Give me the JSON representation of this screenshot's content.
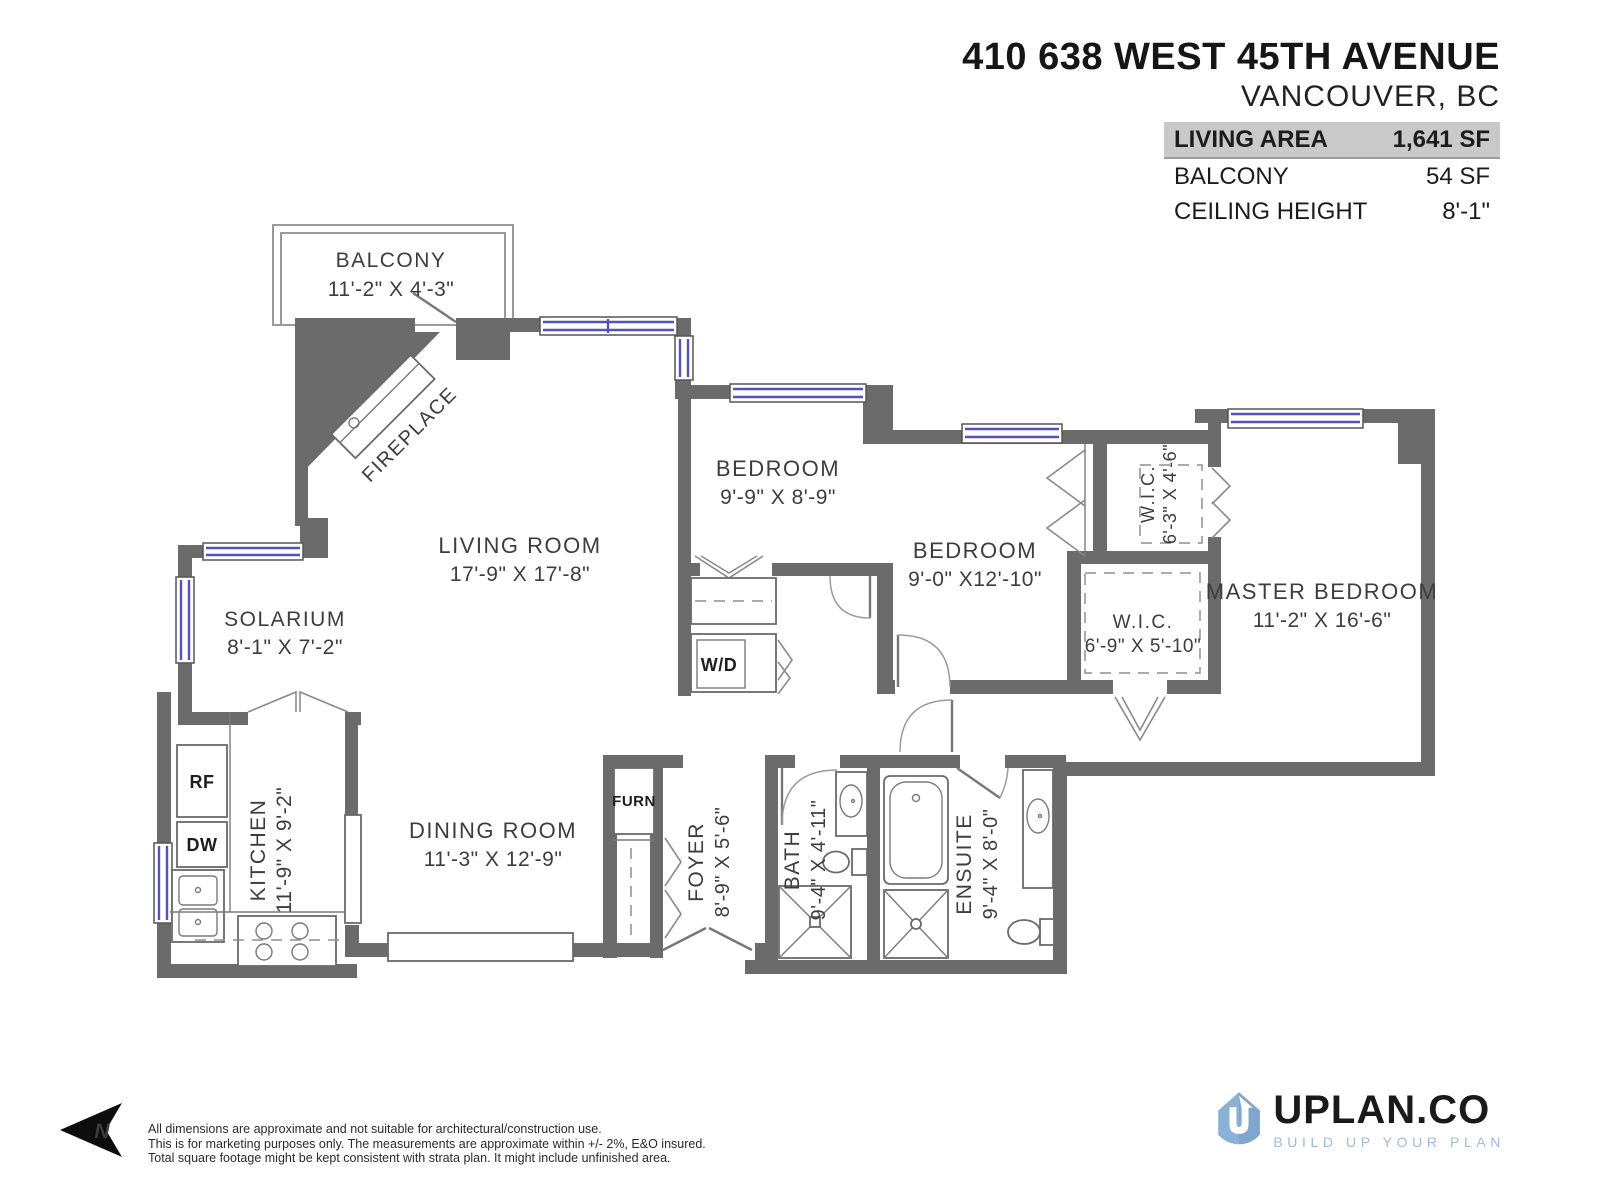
{
  "header": {
    "address": "410 638 WEST 45TH AVENUE",
    "city": "VANCOUVER, BC",
    "stats": [
      {
        "label": "LIVING AREA",
        "value": "1,641 SF"
      },
      {
        "label": "BALCONY",
        "value": "54 SF"
      },
      {
        "label": "CEILING HEIGHT",
        "value": "8'-1\""
      }
    ]
  },
  "rooms": {
    "balcony": {
      "name": "BALCONY",
      "dims": "11'-2\" X 4'-3\""
    },
    "living": {
      "name": "LIVING ROOM",
      "dims": "17'-9\" X 17'-8\""
    },
    "bedroom1": {
      "name": "BEDROOM",
      "dims": "9'-9\" X 8'-9\""
    },
    "bedroom2": {
      "name": "BEDROOM",
      "dims": "9'-0\" X12'-10\""
    },
    "wic_top": {
      "name": "W.I.C.",
      "dims": "6'-3\" X 4'-6\""
    },
    "wic_master": {
      "name": "W.I.C.",
      "dims": "6'-9\" X 5'-10\""
    },
    "master": {
      "name": "MASTER BEDROOM",
      "dims": "11'-2\" X 16'-6\""
    },
    "solarium": {
      "name": "SOLARIUM",
      "dims": "8'-1\" X 7'-2\""
    },
    "kitchen": {
      "name": "KITCHEN",
      "dims": "11'-9\" X 9'-2\""
    },
    "dining": {
      "name": "DINING ROOM",
      "dims": "11'-3\" X 12'-9\""
    },
    "foyer": {
      "name": "FOYER",
      "dims": "8'-9\" X 5'-6\""
    },
    "bath": {
      "name": "BATH",
      "dims": "9'-4\" X 4'-11\""
    },
    "ensuite": {
      "name": "ENSUITE",
      "dims": "9'-4\" X 8'-0\""
    }
  },
  "fixtures": {
    "fireplace": "FIREPLACE",
    "wd": "W/D",
    "furn": "FURN",
    "rf": "RF",
    "dw": "DW"
  },
  "compass": {
    "label": "N"
  },
  "footer": {
    "disclaimer": [
      "All dimensions are approximate and not suitable for architectural/construction use.",
      "This is for marketing purposes only. The measurements are approximate within +/- 2%, E&O insured.",
      "Total square footage might be kept consistent with strata plan. It might include unfinished area."
    ]
  },
  "logo": {
    "name": "UPLAN.CO",
    "tagline": "BUILD UP YOUR PLAN"
  }
}
